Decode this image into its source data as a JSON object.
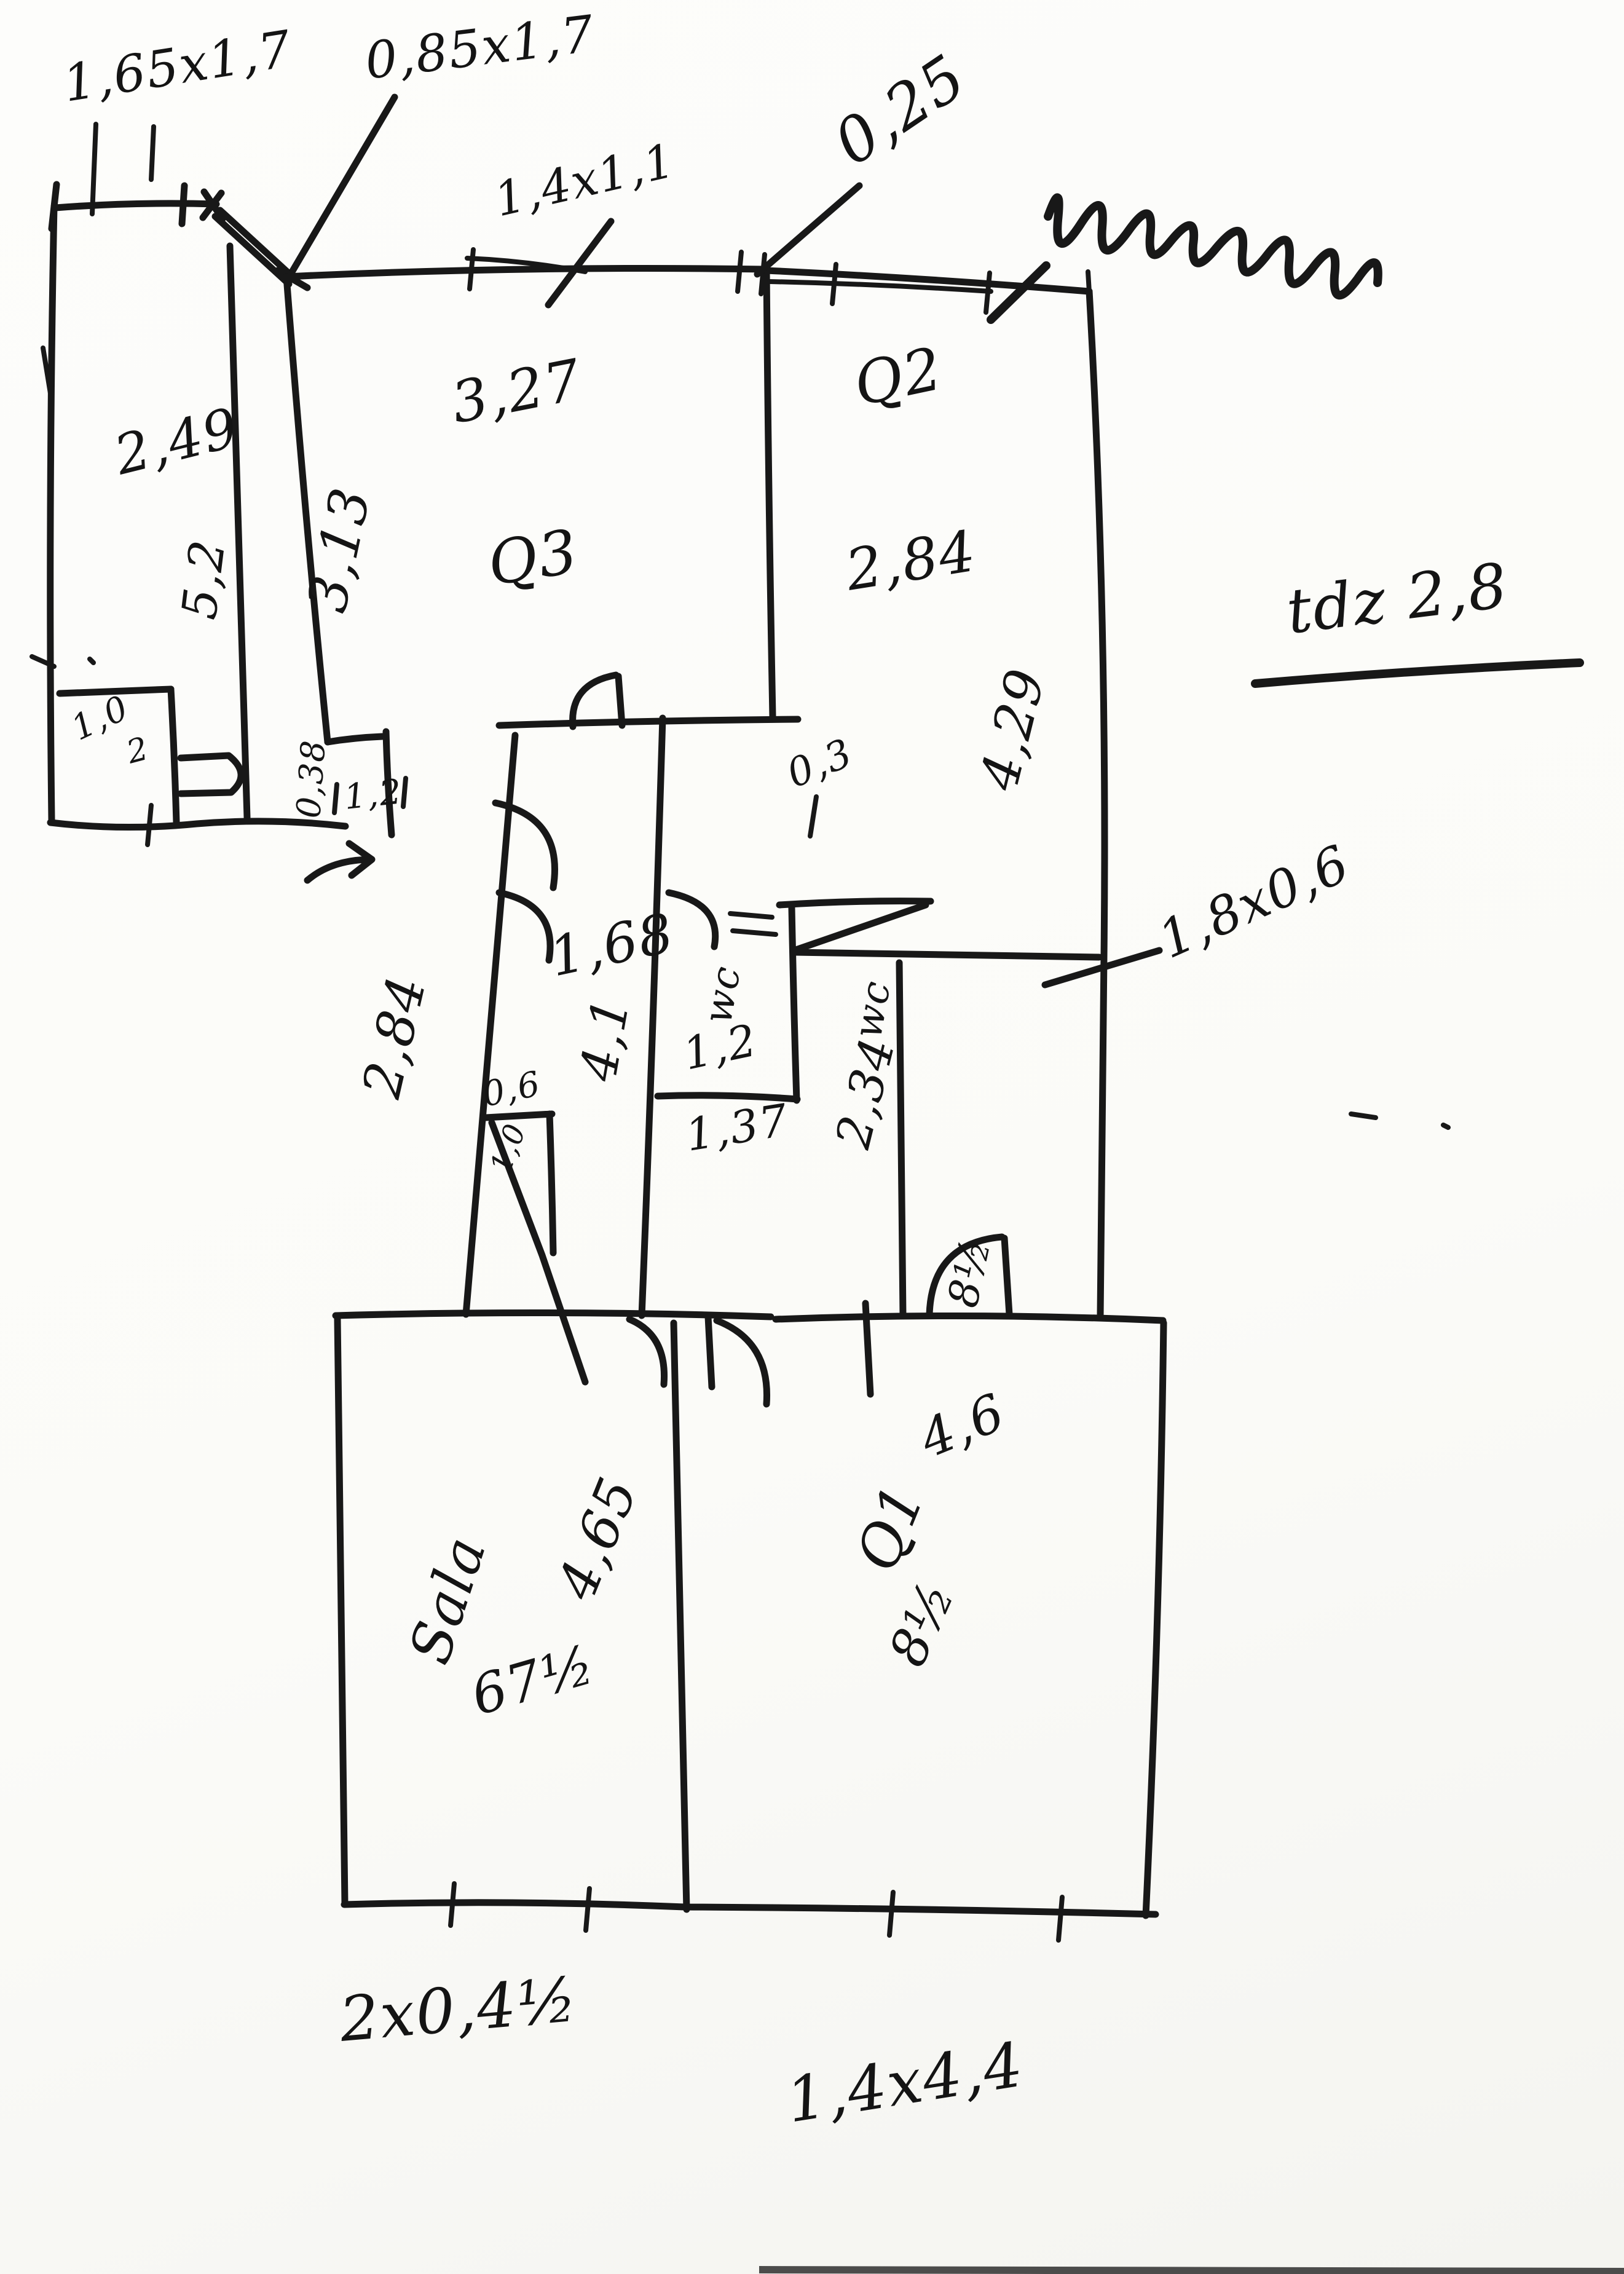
{
  "document": {
    "kind": "hand-drawn floor plan sketch, black ink on scanned white paper",
    "top_right_scribble": "illegible handwritten word (scribble)"
  },
  "labels": {
    "dim_165x17": "1,65x1,7",
    "dim_085x17": "0,85x1,7",
    "dim_14x11": "1,4x1,1",
    "dim_025": "0,25",
    "height_note": "tdz 2,8",
    "room_left_w": "2,49",
    "room_left_h": "5,2",
    "annex_a": "1,0",
    "annex_b": "2",
    "q3_name": "Q3",
    "q3_w": "3,27",
    "q3_h": "3,13",
    "q2_name": "Q2",
    "q2_w": "2,84",
    "q2_h": "4,29",
    "wall_gap": "0,38",
    "door_w": "1,2",
    "dim_03": "0,3",
    "corridor_w": "1,68",
    "corridor_l": "4,1",
    "corridor_side": "2,84",
    "niche_w": "0,6",
    "niche_d": "1,0",
    "bath_name": "wc",
    "bath_w": "1,2",
    "bath_l": "1,37",
    "wc_name": "wc",
    "wc_l": "2,34",
    "wc_area": "8½",
    "fixture_dim": "1,8x0,6",
    "sala_name": "Sala",
    "sala_w": "4,65",
    "sala_area": "67½",
    "q1_name": "Q1",
    "q1_w": "4,6",
    "q1_area": "8½",
    "dim_bottom_left": "2x0,4½",
    "dim_bottom_mid": "1,4x4,4"
  }
}
